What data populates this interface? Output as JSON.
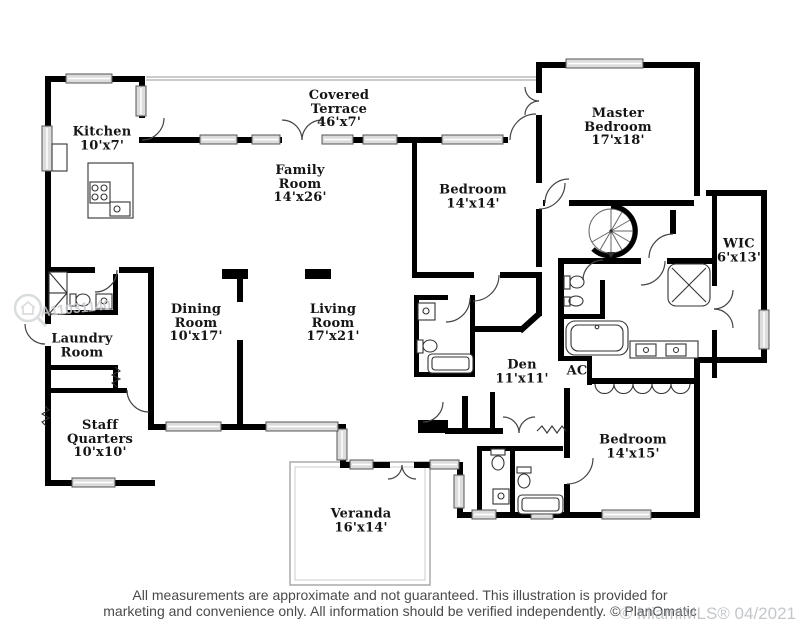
{
  "rooms": {
    "kitchen": {
      "name": "Kitchen",
      "dims": "10'x7'"
    },
    "covered_terrace": {
      "name": "Covered Terrace",
      "dims": "46'x7'"
    },
    "family_room": {
      "name": "Family Room",
      "dims": "14'x26'"
    },
    "master_bedroom": {
      "name": "Master Bedroom",
      "dims": "17'x18'"
    },
    "bedroom_top": {
      "name": "Bedroom",
      "dims": "14'x14'"
    },
    "wic": {
      "name": "WIC",
      "dims": "6'x13'"
    },
    "dining_room": {
      "name": "Dining Room",
      "dims": "10'x17'"
    },
    "living_room": {
      "name": "Living Room",
      "dims": "17'x21'"
    },
    "laundry_room": {
      "name": "Laundry Room",
      "dims": ""
    },
    "den": {
      "name": "Den",
      "dims": "11'x11'"
    },
    "ac": {
      "name": "AC",
      "dims": ""
    },
    "staff_quarters": {
      "name": "Staff Quarters",
      "dims": "10'x10'"
    },
    "bedroom_right": {
      "name": "Bedroom",
      "dims": "14'x15'"
    },
    "veranda": {
      "name": "Veranda",
      "dims": "16'x14'"
    }
  },
  "footer": {
    "line1": "All measurements are approximate and not guaranteed. This illustration is provided for",
    "line2": "marketing and convenience only. All information should be verified independently. © PlanOmatic"
  },
  "watermarks": {
    "listing_number": "A11031140",
    "mls_stamp": "© MiamiMLS® 04/2021"
  },
  "colors": {
    "wall": "#000000",
    "window_fill": "#dcdcdc",
    "label_text": "#151515",
    "footer_text": "#4a4a4a",
    "watermark": "#9fa6ab"
  }
}
